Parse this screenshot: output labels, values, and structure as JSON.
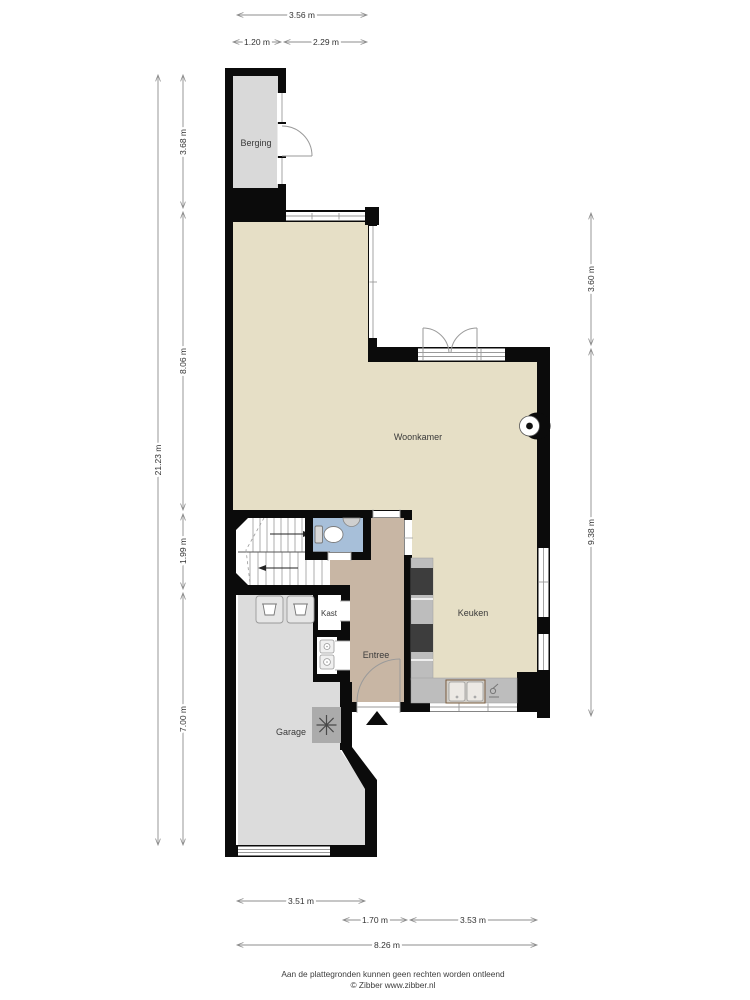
{
  "page": {
    "credit_line1": "Aan de plattegronden kunnen geen rechten worden ontleend",
    "credit_line2": "© Zibber www.zibber.nl"
  },
  "rooms": {
    "berging": "Berging",
    "woonkamer": "Woonkamer",
    "keuken": "Keuken",
    "kast": "Kast",
    "entree": "Entree",
    "garage": "Garage"
  },
  "dimensions": {
    "top": [
      {
        "label": "3.56 m"
      },
      {
        "label": "1.20 m"
      },
      {
        "label": "2.29 m"
      }
    ],
    "left": [
      {
        "label": "3.68 m"
      },
      {
        "label": "8.06 m"
      },
      {
        "label": "1.99 m"
      },
      {
        "label": "7.00 m"
      },
      {
        "label": "21.23 m"
      }
    ],
    "right": [
      {
        "label": "3.60 m"
      },
      {
        "label": "9.38 m"
      }
    ],
    "bottom": [
      {
        "label": "3.51 m"
      },
      {
        "label": "1.70 m"
      },
      {
        "label": "3.53 m"
      },
      {
        "label": "8.26 m"
      }
    ]
  },
  "colors": {
    "wall": "#0b0b0b",
    "living_floor": "#e6dfc6",
    "hall_floor": "#c8b6a4",
    "garage_floor": "#dcdcdc",
    "wc_floor": "#a7bfd9",
    "counter": "#bdbdbd",
    "appliance": "#3d3d3d",
    "dimension_line": "#8c8c8c",
    "label_text": "#3a3a3a"
  },
  "icons": {
    "toilet-icon": "toilet bowl with cistern",
    "washbasin-icon": "half-round basin",
    "kitchen-sink-icon": "double-bowl sink",
    "faucet-icon": "tap",
    "washing-machine-icon": "laundry tub square (x2)",
    "boiler-icon": "asterisk in square",
    "meter-icon": "utility meter (x2)",
    "fireplace-icon": "circle with dot on wall",
    "entrance-icon": "black triangle",
    "stairs-icon": "treads with direction arrows",
    "door-swing-icon": "quarter-circle arc"
  }
}
